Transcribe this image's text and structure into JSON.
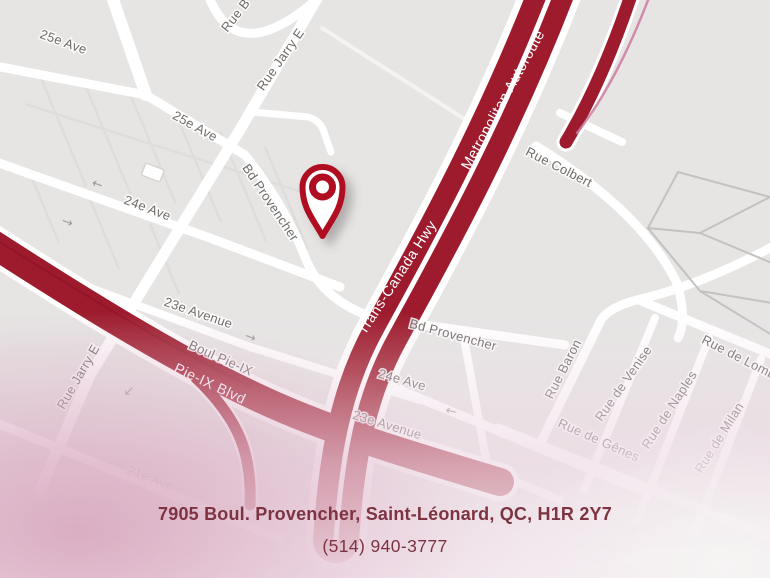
{
  "map": {
    "colors": {
      "background": "#e6e5e4",
      "highway_red": "#9d1b2c",
      "highway_red_dark": "#8e1424",
      "pin_red": "#b01121",
      "label_gray": "#6f6b68",
      "address_maroon": "#7d3342",
      "ramp_magenta": "#cb7ba0"
    },
    "pin": {
      "name": "location-pin",
      "x": 322,
      "y": 200
    },
    "road_labels": [
      {
        "text": "25e Ave",
        "x": 62,
        "y": 46,
        "r": 20,
        "style": ""
      },
      {
        "text": "25e Ave",
        "x": 193,
        "y": 130,
        "r": 29,
        "style": ""
      },
      {
        "text": "Rue Jarry E",
        "x": 284,
        "y": 62,
        "r": -55,
        "style": ""
      },
      {
        "text": "Rue B",
        "x": 239,
        "y": 18,
        "r": -52,
        "style": ""
      },
      {
        "text": "24e Ave",
        "x": 146,
        "y": 212,
        "r": 21,
        "style": ""
      },
      {
        "text": "23e Avenue",
        "x": 197,
        "y": 317,
        "r": 19,
        "style": ""
      },
      {
        "text": "Rue Jarry E",
        "x": 82,
        "y": 379,
        "r": -60,
        "style": ""
      },
      {
        "text": "Boul Pie-IX",
        "x": 219,
        "y": 362,
        "r": 24,
        "style": ""
      },
      {
        "text": "Pie-IX Blvd",
        "x": 208,
        "y": 388,
        "r": 25,
        "style": "on-red"
      },
      {
        "text": "21e Ave",
        "x": 149,
        "y": 482,
        "r": 21,
        "style": "faded"
      },
      {
        "text": "Trans-Canada Hwy",
        "x": 401,
        "y": 280,
        "r": -57,
        "style": "on-red"
      },
      {
        "text": "Metropolitan Autoroute",
        "x": 507,
        "y": 102,
        "r": -61,
        "style": "on-red"
      },
      {
        "text": "Rue Colbert",
        "x": 557,
        "y": 171,
        "r": 27,
        "style": ""
      },
      {
        "text": "Bd Provencher",
        "x": 267,
        "y": 205,
        "r": 56,
        "style": ""
      },
      {
        "text": "Bd Provencher",
        "x": 452,
        "y": 339,
        "r": 15,
        "style": ""
      },
      {
        "text": "24e Ave",
        "x": 401,
        "y": 384,
        "r": 16,
        "style": ""
      },
      {
        "text": "23e Avenue",
        "x": 386,
        "y": 429,
        "r": 17,
        "style": ""
      },
      {
        "text": "Rue Baron",
        "x": 567,
        "y": 371,
        "r": -63,
        "style": ""
      },
      {
        "text": "Rue de Venise",
        "x": 627,
        "y": 386,
        "r": -55,
        "style": ""
      },
      {
        "text": "Rue de Naples",
        "x": 673,
        "y": 412,
        "r": -57,
        "style": ""
      },
      {
        "text": "Rue de Lomb",
        "x": 737,
        "y": 361,
        "r": 27,
        "style": ""
      },
      {
        "text": "Rue de Gênes",
        "x": 597,
        "y": 444,
        "r": 24,
        "style": ""
      },
      {
        "text": "Rue de Milan",
        "x": 723,
        "y": 440,
        "r": -58,
        "style": ""
      }
    ],
    "direction_arrows": [
      {
        "glyph": "←",
        "x": 96,
        "y": 188,
        "r": 20
      },
      {
        "glyph": "→",
        "x": 66,
        "y": 226,
        "r": 20
      },
      {
        "glyph": "→",
        "x": 249,
        "y": 341,
        "r": 20
      },
      {
        "glyph": "↙",
        "x": 129,
        "y": 395,
        "r": 0
      },
      {
        "glyph": "←",
        "x": 450,
        "y": 415,
        "r": 15
      }
    ],
    "footer": {
      "address": "7905 Boul. Provencher, Saint-Léonard, QC, H1R 2Y7",
      "phone": "(514) 940-3777"
    }
  }
}
